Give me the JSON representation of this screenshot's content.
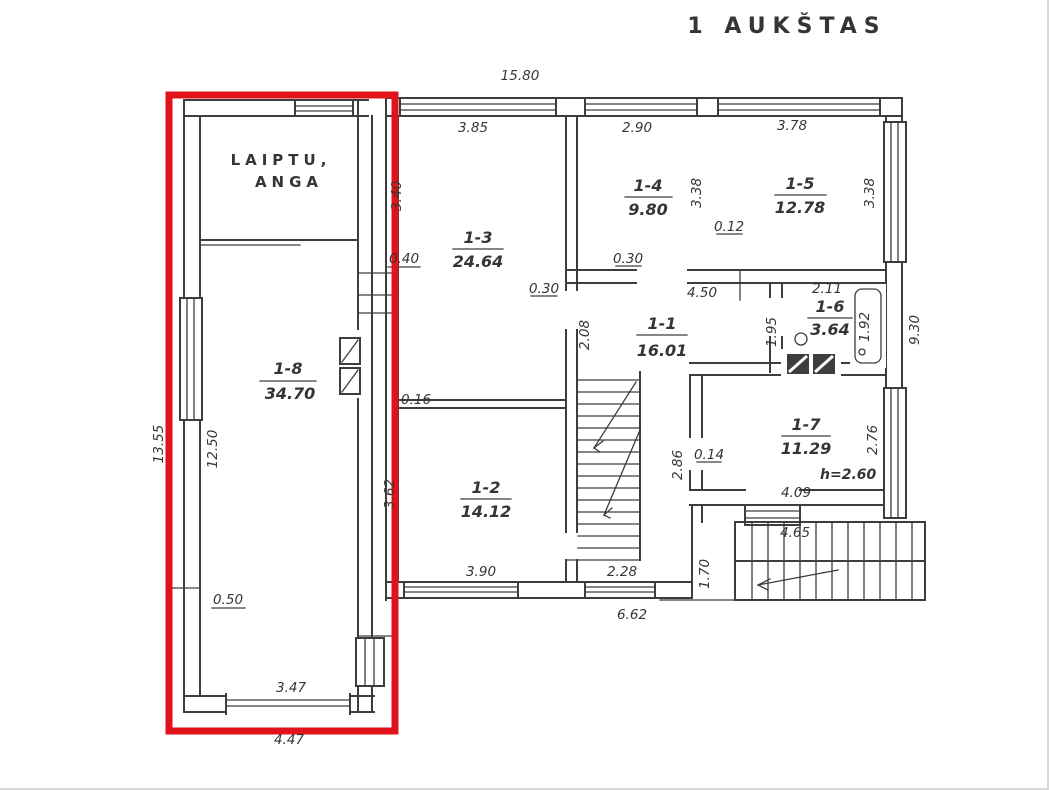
{
  "title": "1 AUKŠTAS",
  "colors": {
    "line": "#3d3d3d",
    "highlight_red": "#e2121b",
    "background": "#ffffff"
  },
  "highlighted_zone": {
    "room_id": "1-8",
    "room_area": "34.70",
    "stair_opening_label_line1": "LAIPTU,",
    "stair_opening_label_line2": "ANGA"
  },
  "rooms": [
    {
      "id": "1-1",
      "area": "16.01"
    },
    {
      "id": "1-2",
      "area": "14.12"
    },
    {
      "id": "1-3",
      "area": "24.64"
    },
    {
      "id": "1-4",
      "area": "9.80"
    },
    {
      "id": "1-5",
      "area": "12.78"
    },
    {
      "id": "1-6",
      "area": "3.64"
    },
    {
      "id": "1-7",
      "area": "11.29"
    },
    {
      "id": "1-8",
      "area": "34.70"
    }
  ],
  "annotations": {
    "ceiling_height": "h=2.60"
  },
  "dimensions": {
    "top_width": "15.80",
    "room13_width": "3.85",
    "room14_width": "2.90",
    "room15_width": "3.78",
    "room14_depth": "3.38",
    "room15_depth": "3.38",
    "room13_side": "3.40",
    "wall_040": "0.40",
    "pier_030_left": "0.30",
    "pier_030_mid": "0.30",
    "gap_012": "0.12",
    "room11_width": "4.50",
    "room16_width": "2.11",
    "room16_depth": "1.95",
    "bath_length": "1.92",
    "right_depth": "9.30",
    "room11_side": "2.08",
    "room17_window": "2.76",
    "room17_width": "4.09",
    "door_014": "0.14",
    "wall_286": "2.86",
    "room12_width": "3.90",
    "room12_side": "3.62",
    "wall_016": "0.16",
    "porch_228": "2.28",
    "bottom_width": "6.62",
    "landing_170": "1.70",
    "ext_stairs_465": "4.65",
    "left_outer": "13.55",
    "left_inner": "12.50",
    "niche_050": "0.50",
    "garage_opening_347": "3.47",
    "bottom_outer_447": "4.47"
  }
}
